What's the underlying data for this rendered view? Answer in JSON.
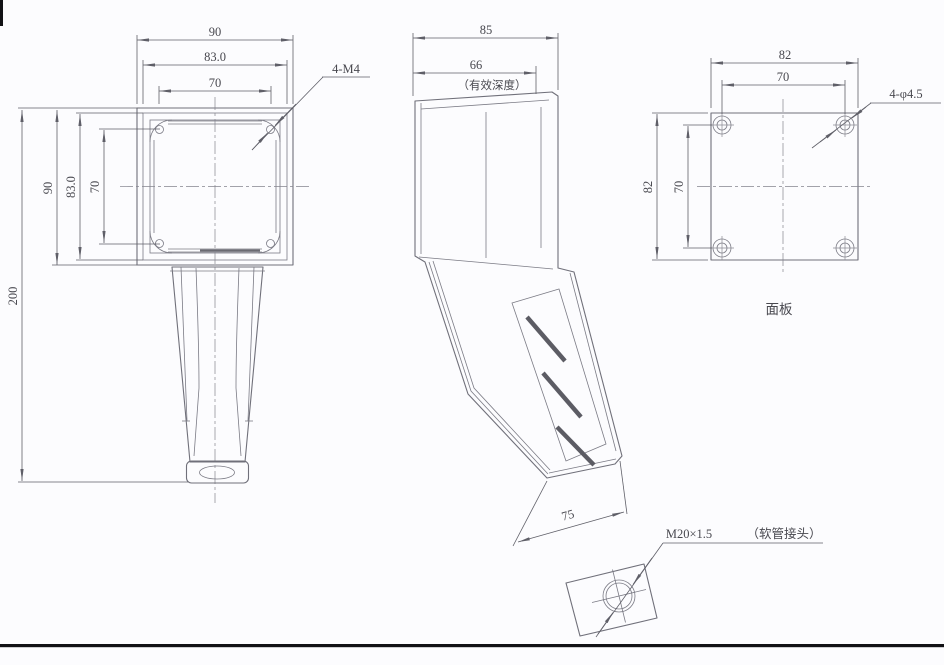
{
  "drawing": {
    "front_view": {
      "dim_width_outer": "90",
      "dim_width_lid": "83.0",
      "dim_width_holes": "70",
      "dim_height_outer": "90",
      "dim_height_lid": "83.0",
      "dim_height_holes": "70",
      "dim_total_height": "200",
      "thread_callout": "4-M4"
    },
    "side_view": {
      "dim_depth_outer": "85",
      "dim_depth_effective": "66",
      "effective_depth_note": "（有效深度）",
      "dim_handle_bottom": "75"
    },
    "panel_view": {
      "dim_width": "82",
      "dim_hole_spacing_h": "70",
      "dim_height": "82",
      "dim_hole_spacing_v": "70",
      "hole_callout": "4-φ4.5",
      "label": "面板"
    },
    "connector_detail": {
      "thread_spec": "M20×1.5",
      "note": "（软管接头）"
    },
    "colors": {
      "line_ink": "#70707a",
      "dim_ink": "#5f5f68",
      "text_ink": "#48484f",
      "border_black": "#121215",
      "background": "#fcfcfe"
    }
  }
}
